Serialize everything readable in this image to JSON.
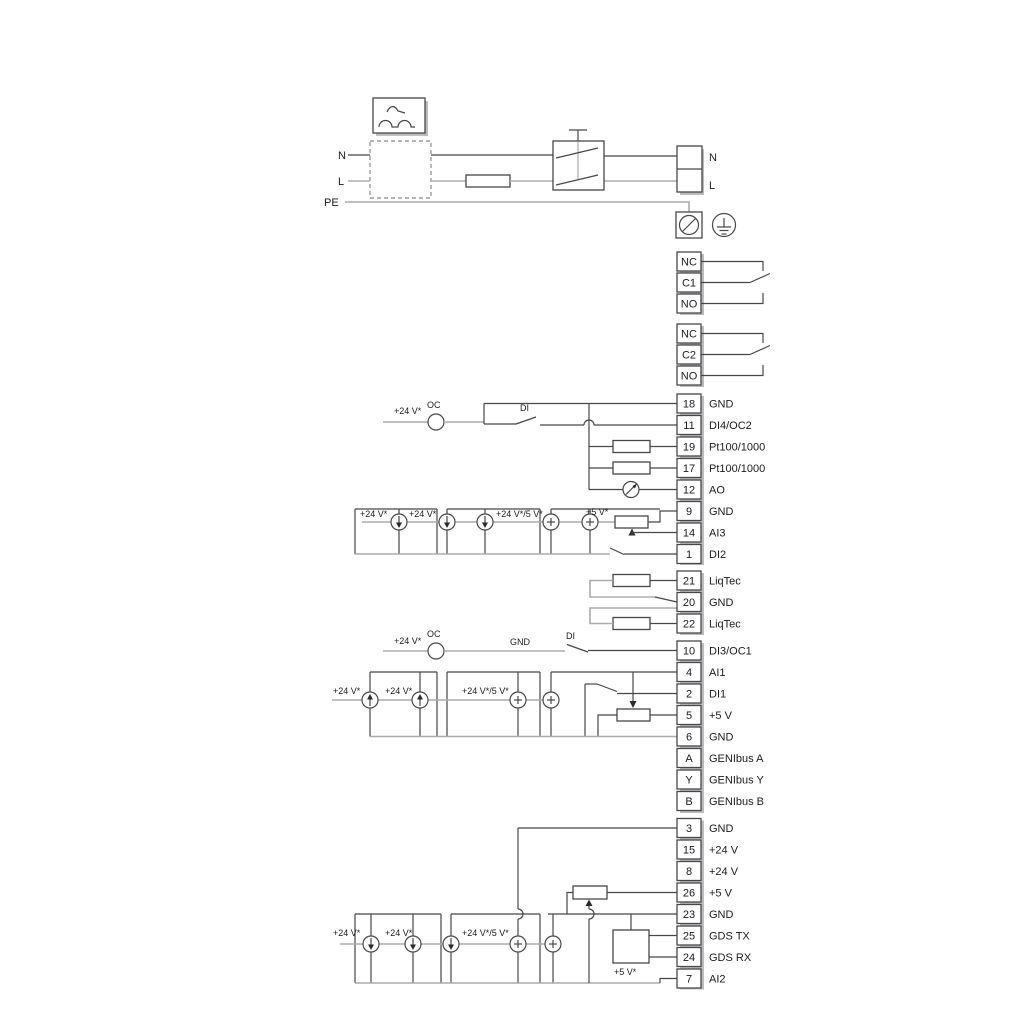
{
  "power": {
    "n_left": "N",
    "l_left": "L",
    "pe": "PE",
    "n_right": "N",
    "l_right": "L"
  },
  "relays": {
    "r1": [
      "NC",
      "C1",
      "NO"
    ],
    "r2": [
      "NC",
      "C2",
      "NO"
    ]
  },
  "terminals": {
    "g1": [
      {
        "num": "18",
        "label": "GND"
      },
      {
        "num": "11",
        "label": "DI4/OC2"
      },
      {
        "num": "19",
        "label": "Pt100/1000"
      },
      {
        "num": "17",
        "label": "Pt100/1000"
      },
      {
        "num": "12",
        "label": "AO"
      },
      {
        "num": "9",
        "label": "GND"
      },
      {
        "num": "14",
        "label": "AI3"
      },
      {
        "num": "1",
        "label": "DI2"
      }
    ],
    "g2": [
      {
        "num": "21",
        "label": "LiqTec"
      },
      {
        "num": "20",
        "label": "GND"
      },
      {
        "num": "22",
        "label": "LiqTec"
      }
    ],
    "g3": [
      {
        "num": "10",
        "label": "DI3/OC1"
      },
      {
        "num": "4",
        "label": "AI1"
      },
      {
        "num": "2",
        "label": "DI1"
      },
      {
        "num": "5",
        "label": "+5 V"
      },
      {
        "num": "6",
        "label": "GND"
      },
      {
        "num": "A",
        "label": "GENIbus A"
      },
      {
        "num": "Y",
        "label": "GENIbus Y"
      },
      {
        "num": "B",
        "label": "GENIbus B"
      }
    ],
    "g4": [
      {
        "num": "3",
        "label": "GND"
      },
      {
        "num": "15",
        "label": "+24 V"
      },
      {
        "num": "8",
        "label": "+24 V"
      },
      {
        "num": "26",
        "label": "+5 V"
      },
      {
        "num": "23",
        "label": "GND"
      },
      {
        "num": "25",
        "label": "GDS TX"
      },
      {
        "num": "24",
        "label": "GDS RX"
      },
      {
        "num": "7",
        "label": "AI2"
      }
    ]
  },
  "annotations": {
    "row11": {
      "v24": "+24 V*",
      "oc": "OC",
      "di": "DI"
    },
    "rowAI3": {
      "v24a": "+24 V*",
      "v24b": "+24 V*",
      "v245": "+24 V*/5 V*",
      "v5": "+5 V*"
    },
    "row10": {
      "v24": "+24 V*",
      "oc": "OC",
      "gnd": "GND",
      "di": "DI"
    },
    "rowAI1": {
      "v24a": "+24 V*",
      "v24b": "+24 V*",
      "v245": "+24 V*/5 V*"
    },
    "rowAI2": {
      "v24a": "+24 V*",
      "v24b": "+24 V*",
      "v245": "+24 V*/5 V*",
      "v5": "+5 V*"
    }
  },
  "colors": {
    "dark": "#47474a",
    "gray": "#a9abad",
    "text": "#1c1c1c"
  }
}
